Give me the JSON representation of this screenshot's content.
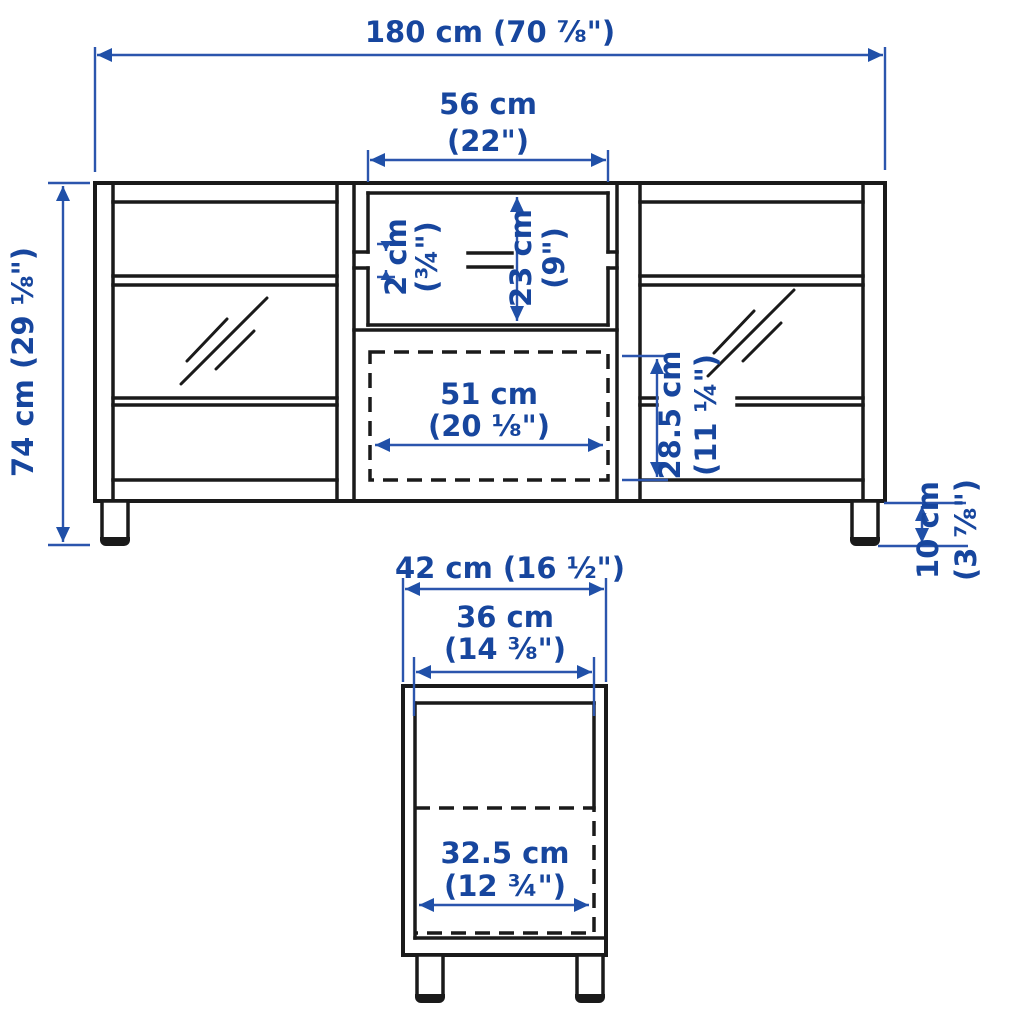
{
  "title": "TV bench dimension diagram",
  "colors": {
    "dimension_text_blue": "#17469E",
    "dimension_line_blue": "#2B55AD",
    "structure_black": "#1a1a1a",
    "background": "#ffffff"
  },
  "front_view": {
    "overall_width": "180 cm (70 ⅞\")",
    "opening_width_line1": "56 cm",
    "opening_width_line2": "(22\")",
    "shelf_thickness_line1": "2 cm",
    "shelf_thickness_line2": "(¾\")",
    "opening_height_line1": "23 cm",
    "opening_height_line2": "(9\")",
    "drawer_width_line1": "51 cm",
    "drawer_width_line2": "(20 ⅛\")",
    "drawer_height_line1": "28.5 cm",
    "drawer_height_line2": "(11 ¼\")",
    "overall_height": "74 cm (29 ⅛\")",
    "leg_height_line1": "10 cm",
    "leg_height_line2": "(3 ⅞\")"
  },
  "side_view": {
    "overall_depth": "42 cm (16 ½\")",
    "inner_depth_line1": "36 cm",
    "inner_depth_line2": "(14 ⅜\")",
    "drawer_depth_line1": "32.5 cm",
    "drawer_depth_line2": "(12 ¾\")"
  }
}
